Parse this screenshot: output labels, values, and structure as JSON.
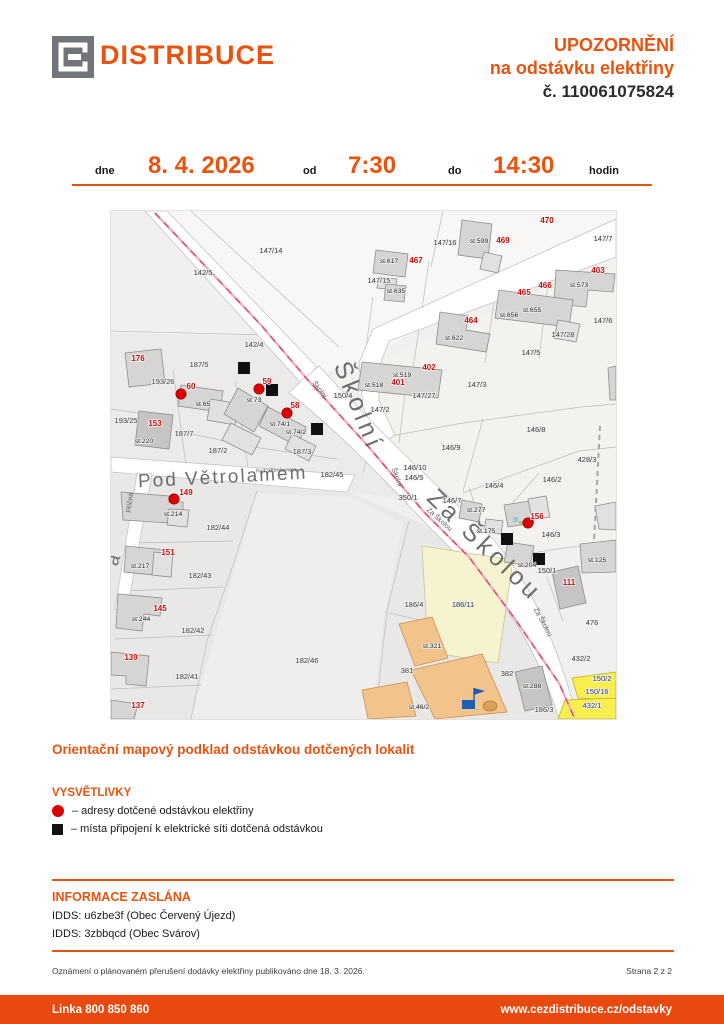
{
  "header": {
    "brand": "DISTRIBUCE",
    "title_line1": "UPOZORNĚNÍ",
    "title_line2": "na odstávku elektřiny",
    "title_line3": "č. 110061075824"
  },
  "schedule": {
    "date_label": "dne",
    "date": "8. 4. 2026",
    "from_label": "od",
    "from_time": "7:30",
    "to_label": "do",
    "to_time": "14:30",
    "unit_label": "hodin"
  },
  "map": {
    "caption": "Orientační mapový podklad odstávkou dotčených lokalit",
    "labels": [
      {
        "t": "Školní",
        "c": "S",
        "x": 240,
        "y": 198,
        "r": 68
      },
      {
        "t": "Za Školou",
        "c": "S",
        "x": 368,
        "y": 340,
        "r": 44
      },
      {
        "t": "Pod Větrolamem",
        "c": "S2",
        "x": 112,
        "y": 272,
        "r": -3
      },
      {
        "t": "á",
        "c": "S2",
        "x": 8,
        "y": 350,
        "r": -70
      },
      {
        "t": "Školní",
        "c": "s",
        "x": 207,
        "y": 180,
        "r": 52
      },
      {
        "t": "Školní",
        "c": "s",
        "x": 284,
        "y": 267,
        "r": 70
      },
      {
        "t": "Za Školou",
        "c": "s",
        "x": 327,
        "y": 310,
        "r": 42
      },
      {
        "t": "Za Školou",
        "c": "s",
        "x": 430,
        "y": 412,
        "r": 62
      },
      {
        "t": "Pod Větrolamem",
        "c": "s2",
        "x": 165,
        "y": 261,
        "r": -2
      },
      {
        "t": "Příčná",
        "c": "s",
        "x": 21,
        "y": 292,
        "r": -84
      },
      {
        "t": "142/5",
        "c": "p",
        "x": 92,
        "y": 64
      },
      {
        "t": "147/14",
        "c": "p",
        "x": 160,
        "y": 42
      },
      {
        "t": "147/16",
        "c": "p",
        "x": 334,
        "y": 34
      },
      {
        "t": "147/7",
        "c": "p",
        "x": 492,
        "y": 30
      },
      {
        "t": "147/15",
        "c": "p",
        "x": 268,
        "y": 72
      },
      {
        "t": "147/6",
        "c": "p",
        "x": 492,
        "y": 112
      },
      {
        "t": "147/28",
        "c": "p",
        "x": 452,
        "y": 126
      },
      {
        "t": "147/5",
        "c": "p",
        "x": 420,
        "y": 144
      },
      {
        "t": "147/3",
        "c": "p",
        "x": 366,
        "y": 176
      },
      {
        "t": "147/27",
        "c": "p",
        "x": 313,
        "y": 187
      },
      {
        "t": "147/2",
        "c": "p",
        "x": 269,
        "y": 201
      },
      {
        "t": "146/8",
        "c": "p",
        "x": 425,
        "y": 221
      },
      {
        "t": "146/9",
        "c": "p",
        "x": 340,
        "y": 239
      },
      {
        "t": "428/3",
        "c": "p",
        "x": 476,
        "y": 251
      },
      {
        "t": "146/10",
        "c": "p",
        "x": 304,
        "y": 259
      },
      {
        "t": "146/5",
        "c": "p",
        "x": 303,
        "y": 269
      },
      {
        "t": "182/45",
        "c": "p",
        "x": 221,
        "y": 266
      },
      {
        "t": "350/1",
        "c": "p",
        "x": 297,
        "y": 289
      },
      {
        "t": "146/7",
        "c": "p",
        "x": 341,
        "y": 292
      },
      {
        "t": "146/4",
        "c": "p",
        "x": 383,
        "y": 277
      },
      {
        "t": "146/2",
        "c": "p",
        "x": 441,
        "y": 271
      },
      {
        "t": "142/4",
        "c": "p",
        "x": 143,
        "y": 136
      },
      {
        "t": "187/5",
        "c": "p",
        "x": 88,
        "y": 156
      },
      {
        "t": "193/26",
        "c": "p",
        "x": 52,
        "y": 173
      },
      {
        "t": "150/4",
        "c": "p",
        "x": 232,
        "y": 187
      },
      {
        "t": "193/25",
        "c": "p",
        "x": 15,
        "y": 212
      },
      {
        "t": "187/7",
        "c": "p",
        "x": 73,
        "y": 225
      },
      {
        "t": "187/2",
        "c": "p",
        "x": 107,
        "y": 242
      },
      {
        "t": "187/3",
        "c": "p",
        "x": 191,
        "y": 243
      },
      {
        "t": "146/3",
        "c": "p",
        "x": 440,
        "y": 326
      },
      {
        "t": "150/1",
        "c": "p",
        "x": 436,
        "y": 362
      },
      {
        "t": "476",
        "c": "p",
        "x": 481,
        "y": 414
      },
      {
        "t": "186/4",
        "c": "p",
        "x": 303,
        "y": 396
      },
      {
        "t": "186/11",
        "c": "p",
        "x": 352,
        "y": 396
      },
      {
        "t": "381",
        "c": "p",
        "x": 296,
        "y": 462
      },
      {
        "t": "382",
        "c": "p",
        "x": 396,
        "y": 465
      },
      {
        "t": "186/3",
        "c": "p",
        "x": 433,
        "y": 501
      },
      {
        "t": "432/2",
        "c": "p",
        "x": 470,
        "y": 450
      },
      {
        "t": "150/2",
        "c": "p",
        "x": 491,
        "y": 470
      },
      {
        "t": "150/16",
        "c": "p",
        "x": 486,
        "y": 483
      },
      {
        "t": "432/1",
        "c": "p",
        "x": 481,
        "y": 497
      },
      {
        "t": "182/44",
        "c": "p",
        "x": 107,
        "y": 319
      },
      {
        "t": "182/43",
        "c": "p",
        "x": 89,
        "y": 367
      },
      {
        "t": "182/42",
        "c": "p",
        "x": 82,
        "y": 422
      },
      {
        "t": "182/41",
        "c": "p",
        "x": 76,
        "y": 468
      },
      {
        "t": "182/46",
        "c": "p",
        "x": 196,
        "y": 452
      },
      {
        "t": "st.599",
        "c": "b",
        "x": 368,
        "y": 32
      },
      {
        "t": "st.617",
        "c": "b",
        "x": 278,
        "y": 52
      },
      {
        "t": "st.635",
        "c": "b",
        "x": 285,
        "y": 82
      },
      {
        "t": "st.573",
        "c": "b",
        "x": 468,
        "y": 76
      },
      {
        "t": "st.655",
        "c": "b",
        "x": 421,
        "y": 101
      },
      {
        "t": "st.656",
        "c": "b",
        "x": 398,
        "y": 106
      },
      {
        "t": "st.622",
        "c": "b",
        "x": 343,
        "y": 129
      },
      {
        "t": "st.519",
        "c": "b",
        "x": 291,
        "y": 166
      },
      {
        "t": "st.518",
        "c": "b",
        "x": 263,
        "y": 176
      },
      {
        "t": "st.65",
        "c": "b",
        "x": 92,
        "y": 195
      },
      {
        "t": "st.73",
        "c": "b",
        "x": 143,
        "y": 191
      },
      {
        "t": "st.74/1",
        "c": "b",
        "x": 169,
        "y": 215
      },
      {
        "t": "st.74/2",
        "c": "b",
        "x": 185,
        "y": 223
      },
      {
        "t": "st.220",
        "c": "b",
        "x": 33,
        "y": 232
      },
      {
        "t": "st.277",
        "c": "b",
        "x": 365,
        "y": 301
      },
      {
        "t": "st.175",
        "c": "b",
        "x": 375,
        "y": 322
      },
      {
        "t": "st.204",
        "c": "b",
        "x": 416,
        "y": 356
      },
      {
        "t": "st.125",
        "c": "b",
        "x": 486,
        "y": 351
      },
      {
        "t": "st.214",
        "c": "b",
        "x": 62,
        "y": 305
      },
      {
        "t": "st.217",
        "c": "b",
        "x": 29,
        "y": 357
      },
      {
        "t": "st.244",
        "c": "b",
        "x": 30,
        "y": 410
      },
      {
        "t": "st.321",
        "c": "b",
        "x": 321,
        "y": 437
      },
      {
        "t": "st.288",
        "c": "b",
        "x": 421,
        "y": 477
      },
      {
        "t": "st.46/2",
        "c": "b",
        "x": 308,
        "y": 498
      },
      {
        "t": "470",
        "c": "r",
        "x": 436,
        "y": 12
      },
      {
        "t": "469",
        "c": "r",
        "x": 392,
        "y": 32
      },
      {
        "t": "467",
        "c": "r",
        "x": 305,
        "y": 52
      },
      {
        "t": "403",
        "c": "r",
        "x": 487,
        "y": 62
      },
      {
        "t": "466",
        "c": "r",
        "x": 434,
        "y": 77
      },
      {
        "t": "465",
        "c": "r",
        "x": 413,
        "y": 84
      },
      {
        "t": "464",
        "c": "r",
        "x": 360,
        "y": 112
      },
      {
        "t": "402",
        "c": "r",
        "x": 318,
        "y": 159
      },
      {
        "t": "401",
        "c": "r",
        "x": 287,
        "y": 174
      },
      {
        "t": "176",
        "c": "r",
        "x": 27,
        "y": 150
      },
      {
        "t": "60",
        "c": "r",
        "x": 80,
        "y": 178
      },
      {
        "t": "59",
        "c": "r",
        "x": 156,
        "y": 173
      },
      {
        "t": "58",
        "c": "r",
        "x": 184,
        "y": 197
      },
      {
        "t": "153",
        "c": "r",
        "x": 44,
        "y": 215
      },
      {
        "t": "149",
        "c": "r",
        "x": 75,
        "y": 284
      },
      {
        "t": "151",
        "c": "r",
        "x": 57,
        "y": 344
      },
      {
        "t": "145",
        "c": "r",
        "x": 49,
        "y": 400
      },
      {
        "t": "139",
        "c": "r",
        "x": 20,
        "y": 449
      },
      {
        "t": "137",
        "c": "r",
        "x": 27,
        "y": 497
      },
      {
        "t": "156",
        "c": "r",
        "x": 426,
        "y": 308
      },
      {
        "t": "111",
        "c": "r",
        "x": 458,
        "y": 374
      }
    ],
    "red_dots": [
      [
        70,
        183
      ],
      [
        148,
        178
      ],
      [
        176,
        202
      ],
      [
        63,
        288
      ],
      [
        417,
        312
      ]
    ],
    "black_squares": [
      [
        133,
        157
      ],
      [
        161,
        179
      ],
      [
        206,
        218
      ],
      [
        396,
        328
      ],
      [
        428,
        348
      ]
    ]
  },
  "legend": {
    "title": "VYSVĚTLIVKY",
    "items": [
      {
        "symbol": "red-dot",
        "text": "– adresy dotčené odstávkou elektřiny"
      },
      {
        "symbol": "black-square",
        "text": "– místa připojení k elektrické síti dotčená odstávkou"
      }
    ]
  },
  "info": {
    "title": "INFORMACE ZASLÁNA",
    "lines": [
      "IDDS: u6zbe3f (Obec Červený Újezd)",
      "IDDS: 3zbbqcd (Obec Svárov)"
    ]
  },
  "footnote": {
    "text": "Oznámení o plánovaném přerušení dodávky elektřiny publikováno dne 18. 3. 2026.",
    "page": "Strana 2 z 2"
  },
  "footer": {
    "phone": "Linka 800 850 860",
    "url": "www.cezdistribuce.cz/odstavky"
  },
  "colors": {
    "orange": "#E8540F",
    "footer_orange": "#E8490F",
    "logo_gray": "#717478",
    "marker_red": "#DD0000",
    "marker_black": "#111111",
    "red_label": "#C41111",
    "school_orange": "#F2C48C",
    "parcel_yellow": "#F8EE4E",
    "parcel_pale_yellow": "#F6F3CF",
    "powerline_pink": "#F0AEC6",
    "powerline_red": "#D04058"
  }
}
